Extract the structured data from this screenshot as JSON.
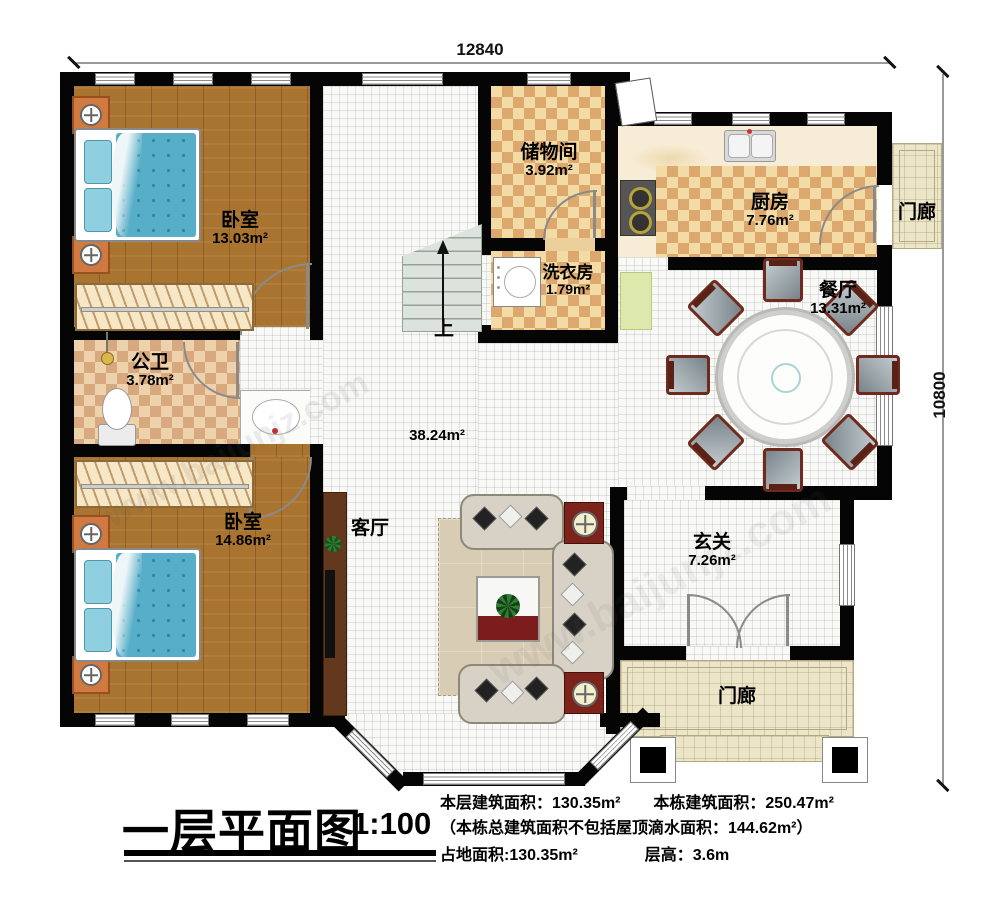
{
  "dimensions": {
    "top": "12840",
    "right": "10800"
  },
  "rooms": {
    "bedroom1": {
      "name": "卧室",
      "area": "13.03m²"
    },
    "bedroom2": {
      "name": "卧室",
      "area": "14.86m²"
    },
    "bath": {
      "name": "公卫",
      "area": "3.78m²"
    },
    "storage": {
      "name": "储物间",
      "area": "3.92m²"
    },
    "laundry": {
      "name": "洗衣房",
      "area": "1.79m²"
    },
    "kitchen": {
      "name": "厨房",
      "area": "7.76m²"
    },
    "dining": {
      "name": "餐厅",
      "area": "13.31m²"
    },
    "living": {
      "name": "客厅",
      "area": "38.24m²"
    },
    "foyer": {
      "name": "玄关",
      "area": "7.26m²"
    },
    "porch_right": {
      "name": "门廊"
    },
    "porch_bottom": {
      "name": "门廊"
    }
  },
  "stairs": {
    "up_label": "上"
  },
  "watermark": {
    "url": "www.baijunjz.com"
  },
  "title_block": {
    "title": "一层平面图",
    "scale": "1:100",
    "line1a": "本层建筑面积：130.35m²",
    "line1b": "本栋建筑面积：250.47m²",
    "line2": "（本栋总建筑面积不包括屋顶滴水面积：144.62m²）",
    "line3a": "占地面积:130.35m²",
    "line3b": "层高：3.6m"
  },
  "colors": {
    "wall": "#050505",
    "wood_floor": "#a9742f",
    "tile_light": "#f3dba6",
    "tile_dark": "#dca86e",
    "bed_blanket": "#57aec9",
    "accent_red": "#7c241c",
    "porch_tile": "#ece5c8"
  }
}
